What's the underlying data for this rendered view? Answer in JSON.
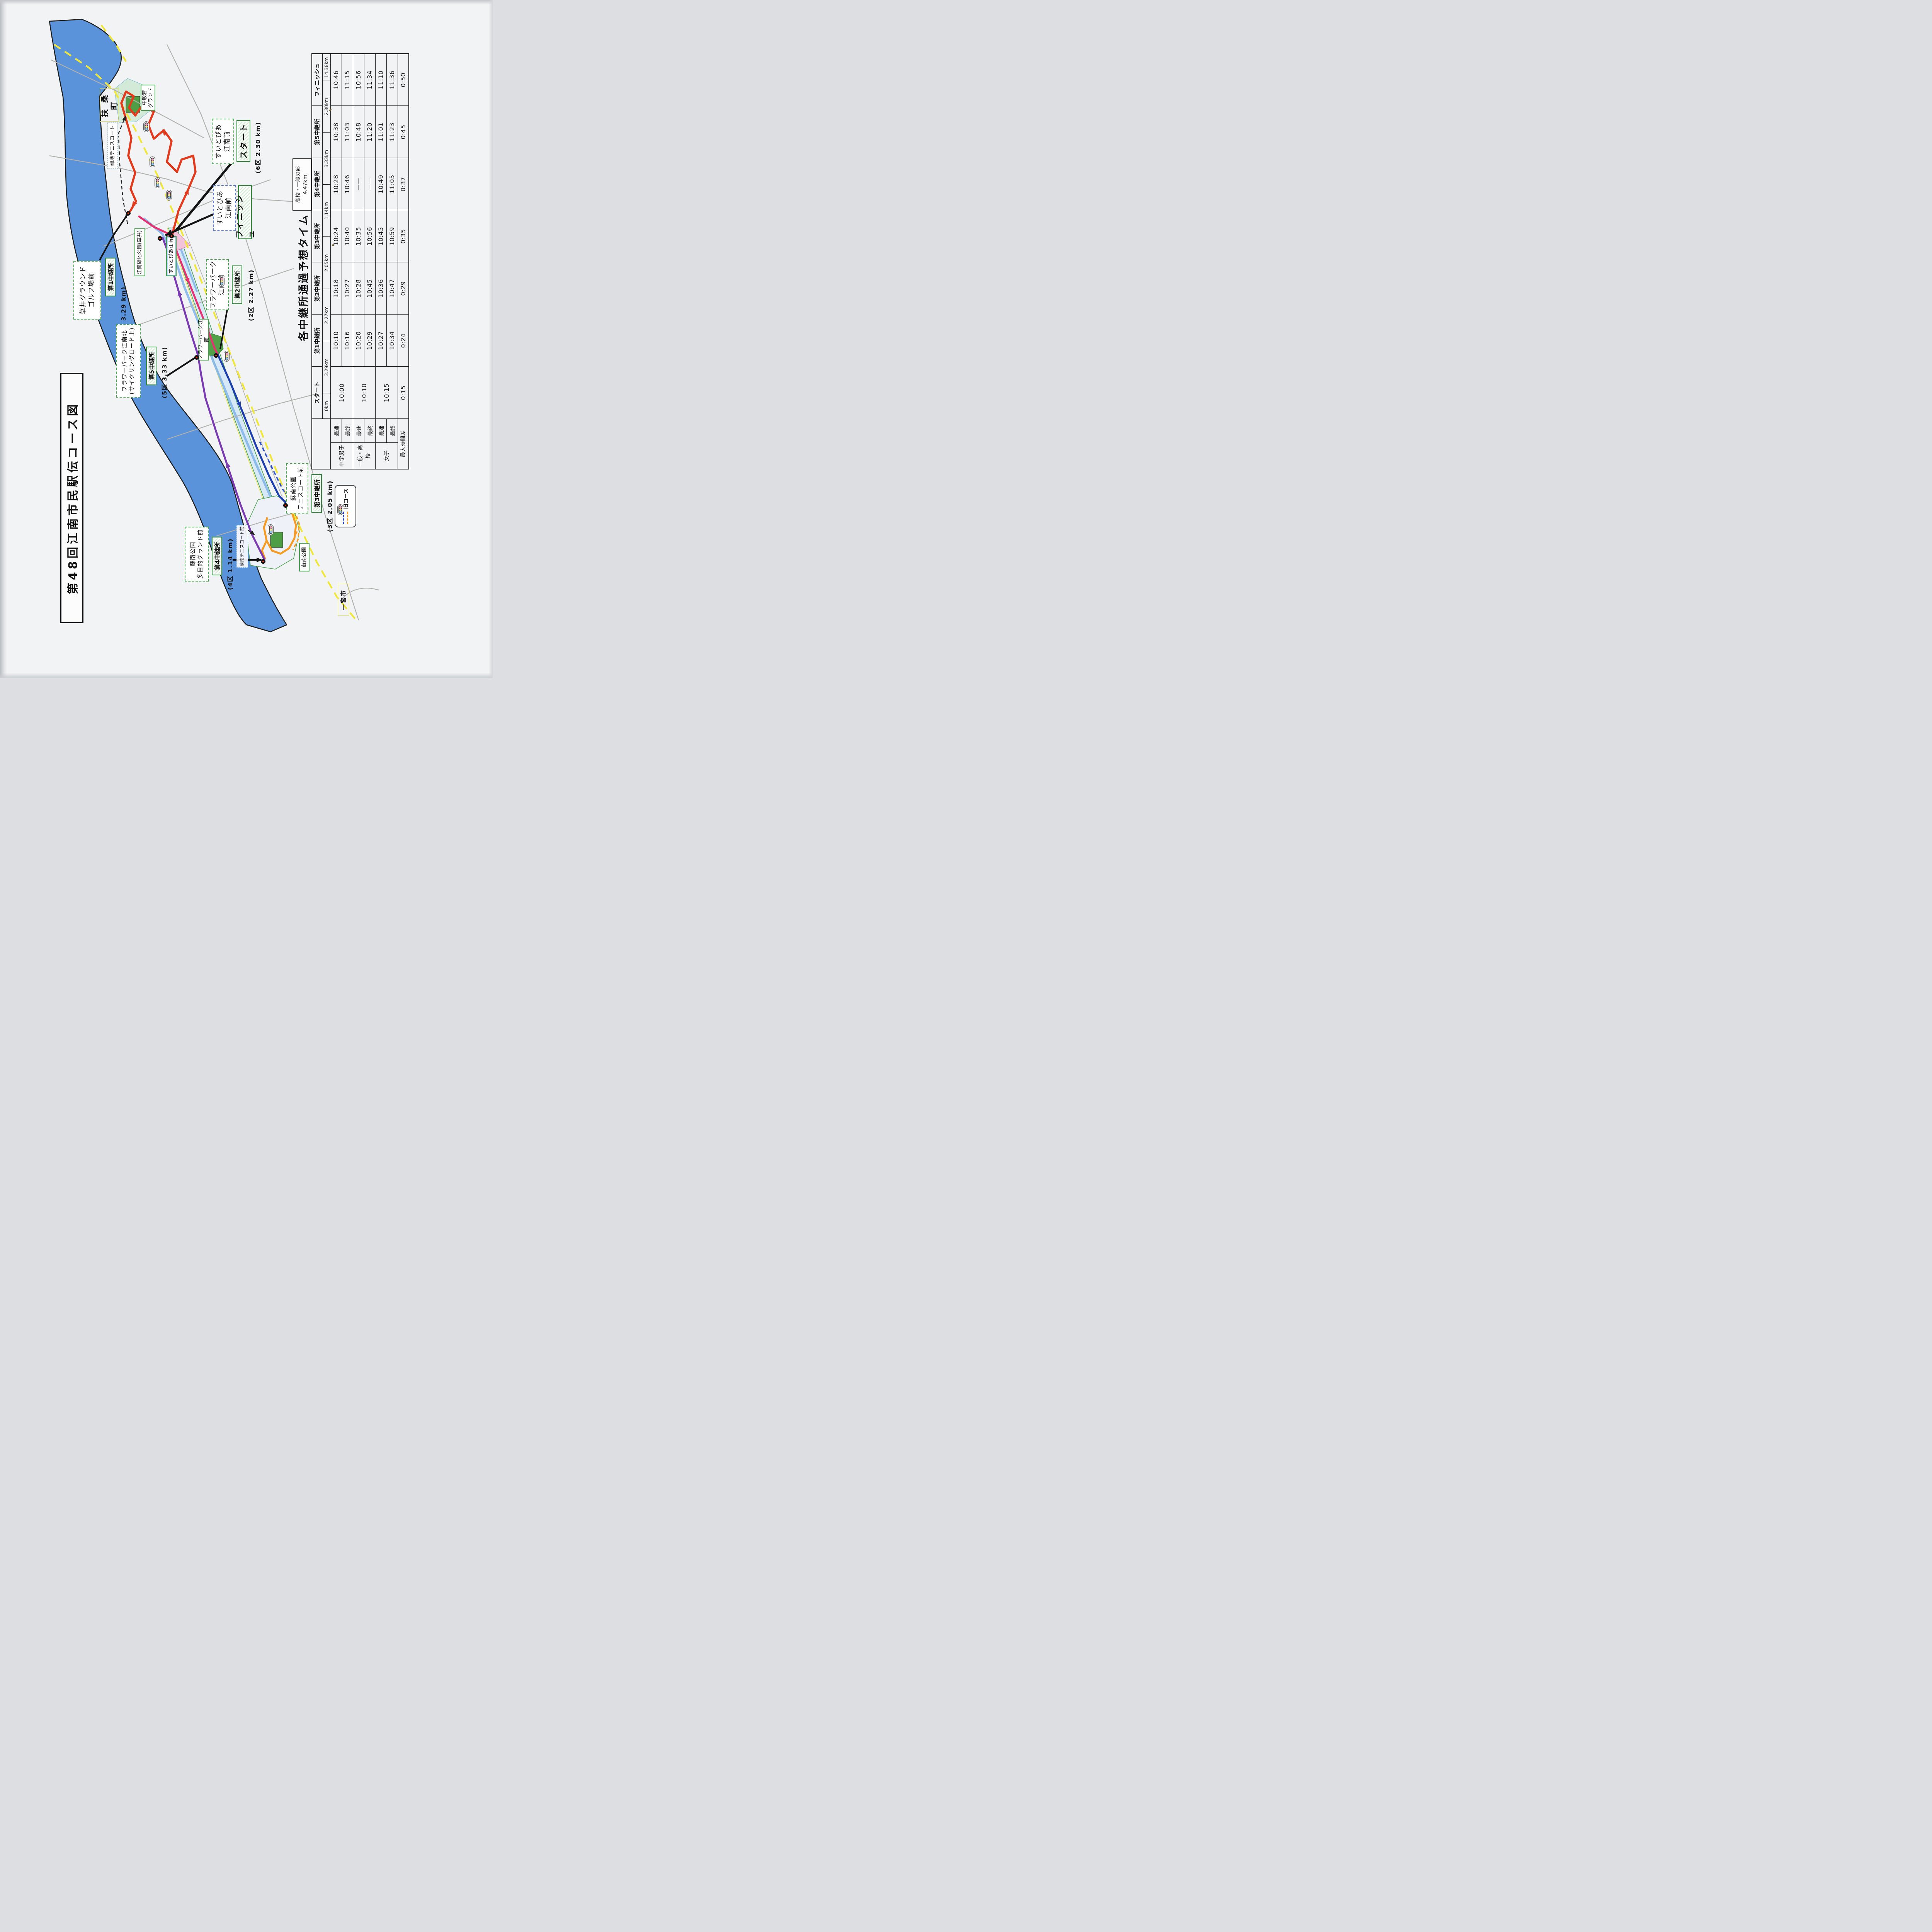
{
  "page": {
    "title": "第48回江南市民駅伝コース図"
  },
  "schedule": {
    "title": "各中継所通過予想タイム",
    "division_note": {
      "label": "高校・一般の部",
      "distance": "4.47km"
    },
    "stations": [
      "スタート",
      "第1中継所",
      "第2中継所",
      "第3中継所",
      "第4中継所",
      "第5中継所",
      "フィニッシュ"
    ],
    "leg_distances": [
      "0km",
      "3.29km",
      "2.27km",
      "2.05km",
      "1.14km",
      "3.33km",
      "2.30km",
      "14.38km"
    ],
    "groups": [
      {
        "name": "中学男子",
        "fastest_label": "最速",
        "last_label": "最終",
        "start": "10:00",
        "fastest": [
          "10:10",
          "10:18",
          "10:24",
          "10:28",
          "10:38",
          "10:46"
        ],
        "last": [
          "10:16",
          "10:27",
          "10:40",
          "10:46",
          "11:03",
          "11:15"
        ]
      },
      {
        "name": "一般・高校",
        "fastest_label": "最速",
        "last_label": "最終",
        "start": "10:10",
        "fastest": [
          "10:20",
          "10:28",
          "10:35",
          "——",
          "10:48",
          "10:56"
        ],
        "last": [
          "10:29",
          "10:45",
          "10:56",
          "——",
          "11:20",
          "11:34"
        ]
      },
      {
        "name": "女子",
        "fastest_label": "最速",
        "last_label": "最終",
        "start": "10:15",
        "fastest": [
          "10:27",
          "10:36",
          "10:45",
          "10:49",
          "11:01",
          "11:10"
        ],
        "last": [
          "10:34",
          "10:47",
          "10:59",
          "11:05",
          "11:23",
          "11:36"
        ]
      }
    ],
    "summary": {
      "name": "最大時間差",
      "times": [
        "0:15",
        "0:24",
        "0:29",
        "0:35",
        "0:37",
        "0:45",
        "0:50"
      ]
    }
  },
  "map": {
    "legend": {
      "label": "旧コース"
    },
    "areas": {
      "fuso": "扶 桑 町",
      "nakahannya": "中般若\nグランド",
      "ryokuchi_tennis": "緑地テニスコート",
      "konan_ryokuchi": "江南緑地公園(草井)",
      "suitopia": "すいとぴあ江南",
      "flower_park": "フラワーパーク江南",
      "sonan_park": "蘇南公園",
      "sonan_tennis": "蘇南テニスコート前",
      "ichinomiya": "一宮市"
    },
    "callouts": {
      "kusai": {
        "place": "草井グラウンド\nゴルフ場前",
        "station": "第1中継所",
        "leg": "(1区 3.29 km)"
      },
      "start": {
        "place": "すいとぴあ\n江南前",
        "station": "スタート",
        "leg": "(6区 2.30 km)"
      },
      "finish": {
        "place": "すいとぴあ\n江南前",
        "station": "フィニッシュ",
        "leg": ""
      },
      "flower2": {
        "place": "フラワーパーク\n江南前",
        "station": "第2中継所",
        "leg": "(2区 2.27 km)"
      },
      "flower5": {
        "place": "フラワーパーク江南北\n(サイクリングロード上)",
        "station": "第5中継所",
        "leg": "(5区 3.33 km)"
      },
      "sonan3": {
        "place": "蘇南公園\nテニスコート前",
        "station": "第3中継所",
        "leg": "(3区 2.05 km)"
      },
      "sonan4": {
        "place": "蘇南公園\n多目的グランド前",
        "station": "第4中継所",
        "leg": "(4区 1.14 km)"
      }
    },
    "colors": {
      "river": "#5b93da",
      "leg1": "#e23a1c",
      "leg2": "#e73272",
      "leg3": "#1d3fae",
      "leg4": "#f59a23",
      "leg5": "#7a3ab2",
      "boundary": "#efe73c",
      "station_box": "#2f8f3c"
    }
  }
}
